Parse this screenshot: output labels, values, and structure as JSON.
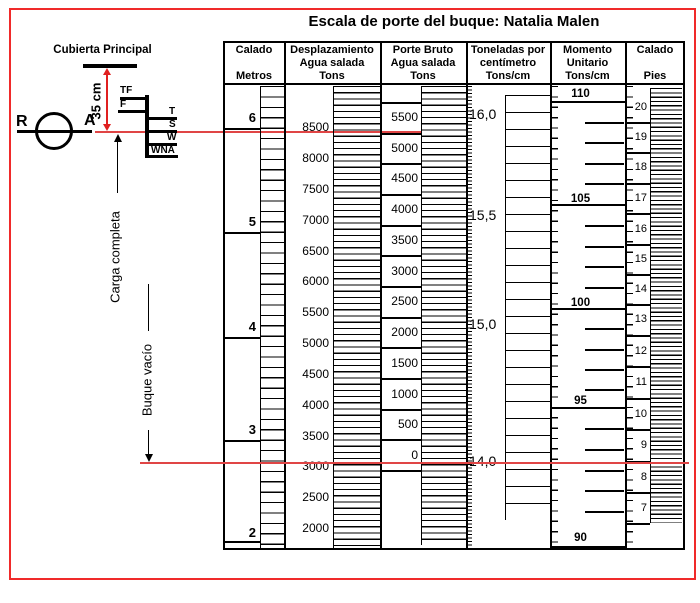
{
  "title": "Escala de porte del buque: Natalia Malen",
  "left_diagram": {
    "deck_label": "Cubierta Principal",
    "gap_label": "35 cm",
    "letter_left": "R",
    "letter_right": "A",
    "loadline_left": [
      "TF",
      "F"
    ],
    "loadline_right": [
      "T",
      "S",
      "W",
      "WNA"
    ],
    "full_load_label": "Carga completa",
    "light_ship_label": "Buque vacío"
  },
  "table": {
    "headers": [
      [
        "Calado",
        "",
        "Metros"
      ],
      [
        "Desplazamiento",
        "Agua salada",
        "Tons"
      ],
      [
        "Porte Bruto",
        "Agua salada",
        "Tons"
      ],
      [
        "Toneladas por",
        "centímetro",
        "Tons/cm"
      ],
      [
        "Momento",
        "Unitario",
        "Tons/cm"
      ],
      [
        "Calado",
        "",
        "Pies"
      ]
    ]
  },
  "scales": {
    "metros": {
      "labels": [
        "6",
        "5",
        "4",
        "3",
        "2"
      ]
    },
    "desplazamiento": {
      "labels": [
        "8500",
        "8000",
        "7500",
        "7000",
        "6500",
        "6000",
        "5500",
        "5000",
        "4500",
        "4000",
        "3500",
        "3000",
        "2500",
        "2000"
      ]
    },
    "porte_bruto": {
      "labels": [
        "5500",
        "5000",
        "4500",
        "4000",
        "3500",
        "3000",
        "2500",
        "2000",
        "1500",
        "1000",
        "500",
        "0"
      ]
    },
    "tpc": {
      "labels": [
        "16,0",
        "15,5",
        "15,0",
        "14,0"
      ]
    },
    "momento": {
      "labels": [
        "110",
        "105",
        "100",
        "95",
        "90"
      ]
    },
    "pies": {
      "labels": [
        "20",
        "19",
        "18",
        "17",
        "16",
        "15",
        "14",
        "13",
        "12",
        "11",
        "10",
        "9",
        "8",
        "7"
      ]
    }
  },
  "chart_data": {
    "type": "table",
    "title": "Escala de porte del buque: Natalia Malen",
    "columns": [
      {
        "header": "Calado Metros",
        "values": [
          6,
          5,
          4,
          3,
          2
        ]
      },
      {
        "header": "Desplazamiento Agua salada Tons",
        "values": [
          8500,
          8000,
          7500,
          7000,
          6500,
          6000,
          5500,
          5000,
          4500,
          4000,
          3500,
          3000,
          2500,
          2000
        ]
      },
      {
        "header": "Porte Bruto Agua salada Tons",
        "values": [
          5500,
          5000,
          4500,
          4000,
          3500,
          3000,
          2500,
          2000,
          1500,
          1000,
          500,
          0
        ]
      },
      {
        "header": "Toneladas por centímetro Tons/cm",
        "values": [
          16.0,
          15.5,
          15.0,
          14.0
        ]
      },
      {
        "header": "Momento Unitario Tons/cm",
        "values": [
          110,
          105,
          100,
          95,
          90
        ]
      },
      {
        "header": "Calado Pies",
        "values": [
          20,
          19,
          18,
          17,
          16,
          15,
          14,
          13,
          12,
          11,
          10,
          9,
          8,
          7
        ]
      }
    ],
    "annotations": [
      "Carga completa",
      "Buque vacío",
      "35 cm",
      "Cubierta Principal"
    ],
    "load_line_marks": [
      "TF",
      "F",
      "T",
      "S",
      "W",
      "WNA"
    ],
    "accent_colors": {
      "frame_red": "#f02a2a",
      "reference_line_red": "#e04545"
    }
  }
}
